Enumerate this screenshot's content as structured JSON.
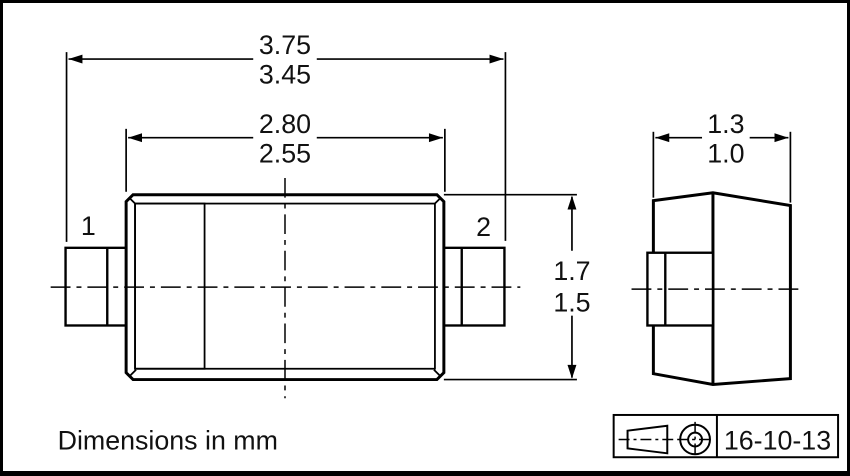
{
  "drawing": {
    "units_note": "Dimensions in mm",
    "title_block": {
      "projection_icon": "first-angle-projection-symbol",
      "date": "16-10-13"
    },
    "front_view": {
      "pin1_label": "1",
      "pin2_label": "2"
    },
    "dimensions": {
      "overall_length": {
        "max": "3.75",
        "min": "3.45"
      },
      "body_length": {
        "max": "2.80",
        "min": "2.55"
      },
      "body_height": {
        "max": "1.7",
        "min": "1.5"
      },
      "body_width": {
        "max": "1.3",
        "min": "1.0"
      }
    },
    "colors": {
      "line": "#000000",
      "background": "#ffffff",
      "cathode_band_fill": "#d2d2d2"
    }
  }
}
